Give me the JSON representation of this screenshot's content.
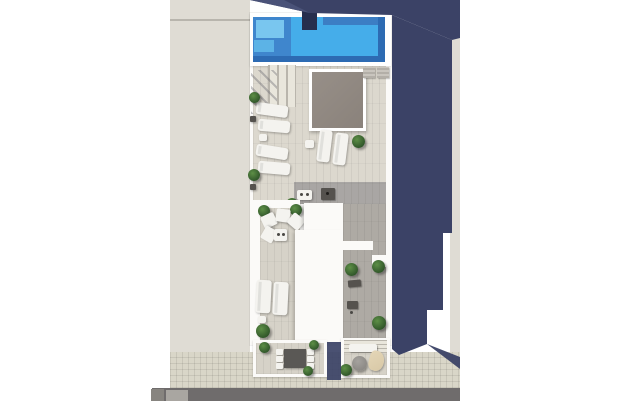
{
  "scene": {
    "type": "architectural-3d-render-top-view",
    "description": "Aerial top-down render of a narrow residential building between neighbor roofs: rooftop pool with steps, skylight patio, sun loungers, shaded lower terrace, two street-side balconies (dining set, pergola lounge), sidewalk and road at bottom, long blue shadow cast to the right"
  },
  "colors": {
    "bg": "#ffffff",
    "navy-shadow": "#3b4266",
    "navy-shadow-light": "#4a5278",
    "pool-water": "#45adea",
    "pool-mid": "#3f86cd",
    "pool-dark": "#2d6bb3",
    "pool-step": "#79c6ef",
    "pool-step2": "#5cb3e6",
    "pool-shade": "#3c7ec4",
    "shower-dark": "#262e4e",
    "neighbor-roof": "#dfdcd4",
    "parapet-line": "#b8b5ad",
    "building-white": "#fbfaf8",
    "deck": "#dcd8ce",
    "deck-lower": "#d6d2c8",
    "deck-shaded": "#aeaaa4",
    "skylight-gray": "#978f88",
    "sidewalk": "#d9d6c8",
    "road": "#6f6c6c",
    "road-mark": "#a9a6a1",
    "car-gray": "#87847f",
    "furniture-white": "#f4f3ef",
    "furniture-dark": "#55524e",
    "table-dark": "#5a5855",
    "plant-dark": "#2f5429",
    "plant-light": "#5d8f46",
    "pergola-slat": "#b9b5ac",
    "pergola-gap": "#e9e6dc",
    "parasol-beige": "#d8c8a6",
    "round-chair": "#8d8a86"
  },
  "inventory": {
    "pool": 1,
    "pool_shower": 1,
    "skylight_patio": 1,
    "sun_loungers_roof": 6,
    "sun_loungers_terrace": 2,
    "lounge_chairs": 4,
    "dining_chairs": 6,
    "dining_table": 1,
    "balconies": 2,
    "pergolas": 2,
    "parasol": 1,
    "round_chair": 1,
    "plants": 16
  }
}
